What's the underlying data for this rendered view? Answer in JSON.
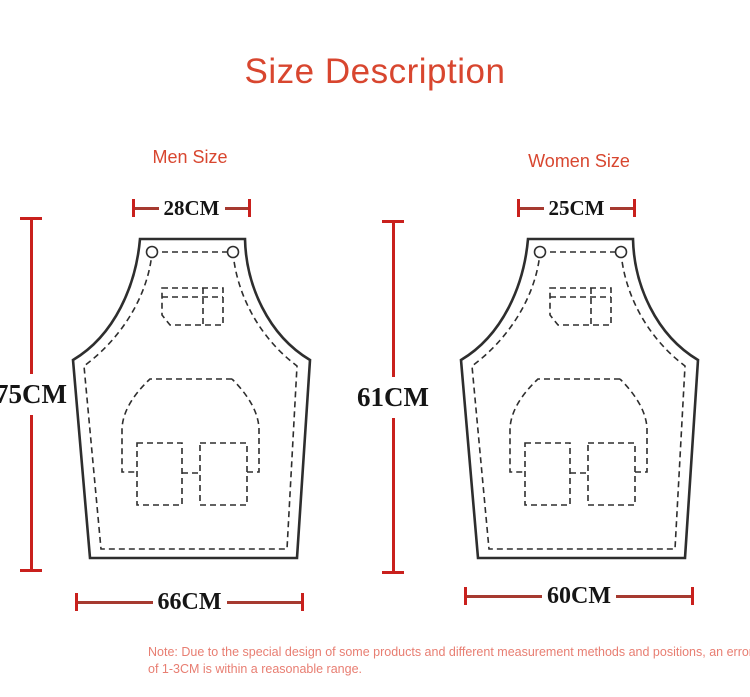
{
  "title": "Size Description",
  "colors": {
    "accent_red": "#d8462f",
    "dimension_cap_red": "#c9201d",
    "dimension_line_red": "#a63a30",
    "measurement_text": "#151515",
    "note_red": "#e87e72",
    "apron_outline": "#2e2e2e"
  },
  "men": {
    "label": "Men Size",
    "top_width": "28CM",
    "height": "75CM",
    "bottom_width": "66CM"
  },
  "women": {
    "label": "Women Size",
    "top_width": "25CM",
    "height": "61CM",
    "bottom_width": "60CM"
  },
  "note": {
    "line1": "Note: Due to the special design of some products and different measurement methods and positions, an error",
    "line2": "of 1-3CM is within a reasonable range."
  }
}
